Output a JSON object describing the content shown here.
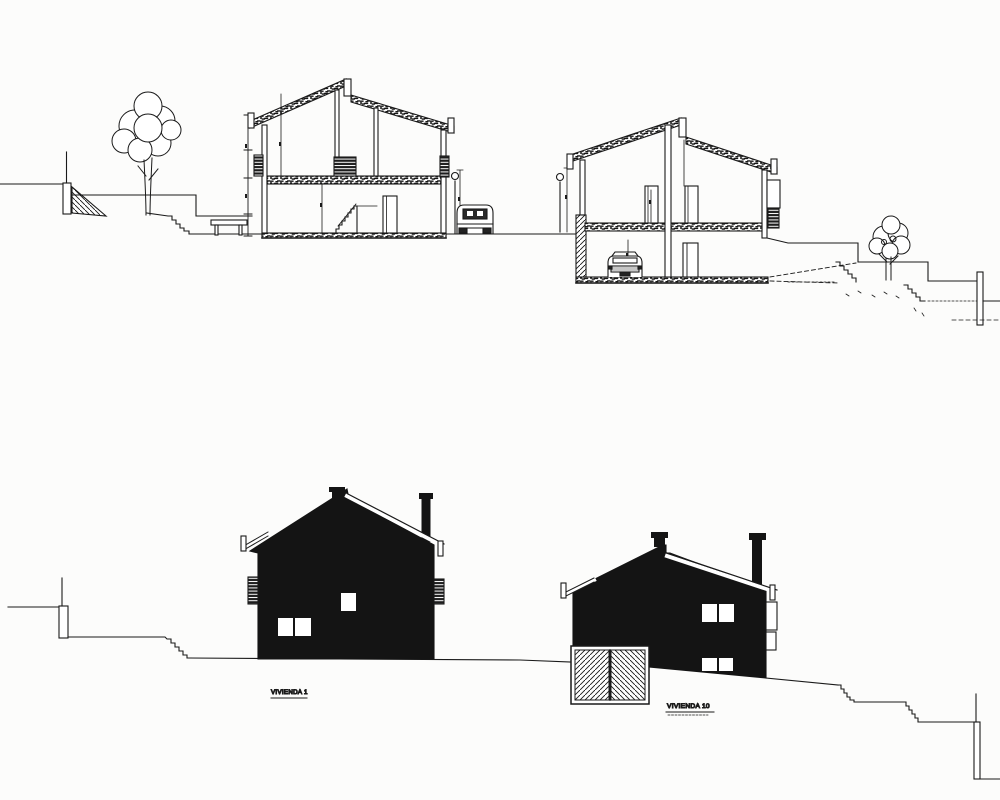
{
  "labels": {
    "house1": "VIVIENDA 1",
    "house2": "VIVIENDA 10"
  },
  "colors": {
    "paper": "#fcfcfb",
    "ink": "#1a1a1a",
    "silhouette": "#141414"
  },
  "drawing": {
    "views": [
      "cross-section of two dwellings on sloped site",
      "side elevations of two dwellings on sloped site"
    ]
  }
}
